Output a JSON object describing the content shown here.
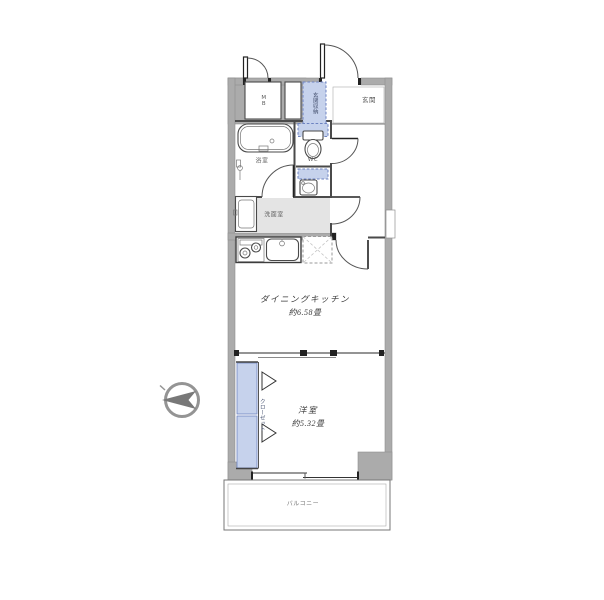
{
  "title": "間取り図",
  "colors": {
    "wall": "#ababab",
    "wallLine": "#8f8f8f",
    "line": "#4a4a4a",
    "floorGray": "#e4e4e4",
    "blueFill": "#c6d2ec",
    "blueStroke": "#6d83c1",
    "label": "#5a5a5a",
    "roomLabel": "#3a3a3a",
    "compass": "#949494",
    "compassArrow": "#787878"
  },
  "rooms": {
    "dining_kitchen": {
      "name": "ダイニングキッチン",
      "size": "約6.58畳"
    },
    "bedroom": {
      "name": "洋室",
      "size": "約5.32畳"
    },
    "bathroom": {
      "label": "浴室"
    },
    "wc": {
      "label": "WC"
    },
    "washroom": {
      "label": "洗面室"
    },
    "entrance": {
      "label": "玄関"
    },
    "entrance_storage": {
      "label": "玄関収納"
    },
    "closet": {
      "label": "クローゼット"
    },
    "meter_box": {
      "label": "MB"
    },
    "balcony": {
      "label": "バルコニー"
    }
  }
}
